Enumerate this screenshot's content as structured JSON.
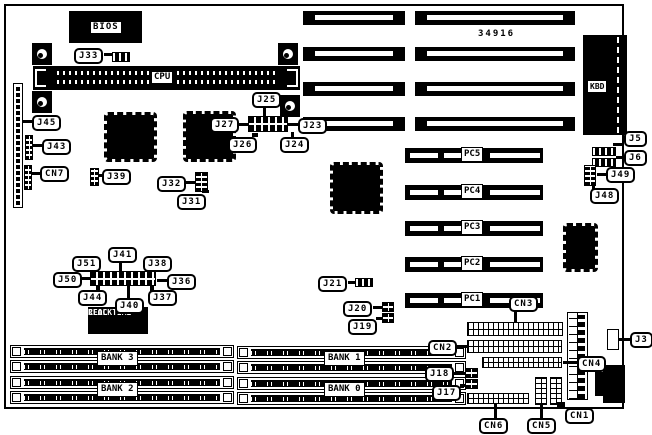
{
  "texts": {
    "bios": "BIOS",
    "cpu": "CPU",
    "kbd": "KBD",
    "board_number": "34916",
    "rtc_line1": "REAL TIME",
    "rtc_line2": "CLOCK"
  },
  "colors": {
    "foreground": "#000000",
    "background": "#ffffff"
  },
  "callouts": [
    {
      "t": "J33",
      "x": 74,
      "y": 48,
      "line": [
        104,
        53,
        9,
        3
      ]
    },
    {
      "t": "J45",
      "x": 32,
      "y": 115,
      "line": [
        22,
        120,
        10,
        3
      ]
    },
    {
      "t": "J43",
      "x": 42,
      "y": 139,
      "line": [
        33,
        144,
        9,
        3
      ]
    },
    {
      "t": "CN7",
      "x": 40,
      "y": 166,
      "line": [
        32,
        172,
        8,
        3
      ]
    },
    {
      "t": "J39",
      "x": 102,
      "y": 169,
      "line": [
        98,
        174,
        5,
        3
      ]
    },
    {
      "t": "J32",
      "x": 157,
      "y": 176,
      "line": [
        183,
        181,
        12,
        3
      ]
    },
    {
      "t": "J31",
      "x": 177,
      "y": 194,
      "line": [
        202,
        190,
        7,
        3
      ]
    },
    {
      "t": "J27",
      "x": 210,
      "y": 117,
      "line": [
        238,
        123,
        10,
        3
      ]
    },
    {
      "t": "J25",
      "x": 252,
      "y": 92,
      "line": [
        263,
        105,
        3,
        12
      ]
    },
    {
      "t": "J26",
      "x": 228,
      "y": 137,
      "line": [
        252,
        133,
        6,
        4
      ]
    },
    {
      "t": "J24",
      "x": 280,
      "y": 137,
      "line": [
        291,
        132,
        3,
        5
      ]
    },
    {
      "t": "J23",
      "x": 298,
      "y": 118,
      "line": [
        288,
        123,
        10,
        3
      ]
    },
    {
      "t": "J21",
      "x": 318,
      "y": 276,
      "line": [
        348,
        281,
        8,
        3
      ]
    },
    {
      "t": "J20",
      "x": 343,
      "y": 301,
      "line": [
        373,
        306,
        9,
        3
      ]
    },
    {
      "t": "J19",
      "x": 348,
      "y": 319,
      "line": [
        376,
        317,
        7,
        3
      ]
    },
    {
      "t": "J51",
      "x": 72,
      "y": 256,
      "line": [
        92,
        268,
        4,
        4
      ]
    },
    {
      "t": "J41",
      "x": 108,
      "y": 247,
      "line": [
        119,
        260,
        3,
        11
      ]
    },
    {
      "t": "J38",
      "x": 143,
      "y": 256,
      "line": [
        148,
        268,
        4,
        4
      ]
    },
    {
      "t": "J50",
      "x": 53,
      "y": 272,
      "line": [
        80,
        277,
        10,
        3
      ]
    },
    {
      "t": "J36",
      "x": 167,
      "y": 274,
      "line": [
        157,
        279,
        10,
        3
      ]
    },
    {
      "t": "J44",
      "x": 78,
      "y": 290,
      "line": [
        96,
        286,
        4,
        5
      ]
    },
    {
      "t": "J40",
      "x": 115,
      "y": 298,
      "line": [
        127,
        284,
        3,
        14
      ]
    },
    {
      "t": "J37",
      "x": 148,
      "y": 290,
      "line": [
        150,
        286,
        4,
        5
      ]
    },
    {
      "t": "J5",
      "x": 624,
      "y": 131,
      "line": [
        613,
        143,
        11,
        3
      ]
    },
    {
      "t": "J6",
      "x": 624,
      "y": 150,
      "line": [
        616,
        156,
        8,
        3
      ]
    },
    {
      "t": "J49",
      "x": 606,
      "y": 167,
      "line": [
        597,
        173,
        9,
        3
      ]
    },
    {
      "t": "J48",
      "x": 590,
      "y": 188,
      "line": [
        592,
        183,
        3,
        6
      ]
    },
    {
      "t": "J3",
      "x": 630,
      "y": 332,
      "line": [
        619,
        338,
        11,
        3
      ]
    },
    {
      "t": "CN3",
      "x": 509,
      "y": 296,
      "line": [
        514,
        311,
        3,
        11
      ]
    },
    {
      "t": "CN2",
      "x": 428,
      "y": 340,
      "line": [
        457,
        345,
        10,
        3
      ]
    },
    {
      "t": "CN4",
      "x": 577,
      "y": 356,
      "line": [
        563,
        361,
        14,
        3
      ]
    },
    {
      "t": "CN6",
      "x": 479,
      "y": 418,
      "line": [
        494,
        404,
        3,
        14
      ]
    },
    {
      "t": "CN5",
      "x": 527,
      "y": 418,
      "line": [
        540,
        404,
        3,
        14
      ]
    },
    {
      "t": "CN1",
      "x": 565,
      "y": 408,
      "line": [
        557,
        402,
        8,
        6
      ]
    },
    {
      "t": "J18",
      "x": 425,
      "y": 366,
      "line": [
        452,
        372,
        13,
        3
      ]
    },
    {
      "t": "J17",
      "x": 432,
      "y": 385,
      "line": [
        460,
        384,
        6,
        3
      ]
    }
  ],
  "isa_slots": {
    "h": 14,
    "items": [
      {
        "x": 303,
        "y": 11,
        "w": 102
      },
      {
        "x": 415,
        "y": 11,
        "w": 160
      },
      {
        "x": 303,
        "y": 47,
        "w": 102
      },
      {
        "x": 415,
        "y": 47,
        "w": 160
      },
      {
        "x": 303,
        "y": 82,
        "w": 102
      },
      {
        "x": 415,
        "y": 82,
        "w": 160
      },
      {
        "x": 303,
        "y": 117,
        "w": 102
      },
      {
        "x": 415,
        "y": 117,
        "w": 160
      }
    ]
  },
  "pc_slots": {
    "x": 405,
    "w": 138,
    "h": 15,
    "items": [
      {
        "label": "PC5",
        "y": 148
      },
      {
        "label": "PC4",
        "y": 185
      },
      {
        "label": "PC3",
        "y": 221
      },
      {
        "label": "PC2",
        "y": 257
      },
      {
        "label": "PC1",
        "y": 293
      }
    ]
  },
  "chips": [
    {
      "x": 104,
      "y": 112,
      "w": 53,
      "h": 50
    },
    {
      "x": 183,
      "y": 111,
      "w": 53,
      "h": 51
    },
    {
      "x": 330,
      "y": 162,
      "w": 53,
      "h": 52
    },
    {
      "x": 563,
      "y": 223,
      "w": 35,
      "h": 49
    }
  ],
  "connectors": [
    {
      "type": "hstrip",
      "x": 112,
      "y": 52,
      "w": 18,
      "h": 10
    },
    {
      "type": "vstrip",
      "x": 13,
      "y": 83,
      "w": 10,
      "h": 125
    },
    {
      "type": "vblock",
      "x": 25,
      "y": 135,
      "w": 8,
      "h": 25
    },
    {
      "type": "vblock",
      "x": 24,
      "y": 165,
      "w": 8,
      "h": 25
    },
    {
      "type": "vblock",
      "x": 90,
      "y": 168,
      "w": 9,
      "h": 18
    },
    {
      "type": "vblock",
      "x": 195,
      "y": 172,
      "w": 13,
      "h": 20
    },
    {
      "type": "jrow",
      "x": 248,
      "y": 116,
      "w": 40,
      "h": 16
    },
    {
      "type": "jrow",
      "x": 90,
      "y": 271,
      "w": 66,
      "h": 15
    },
    {
      "type": "hstrip",
      "x": 355,
      "y": 278,
      "w": 18,
      "h": 9
    },
    {
      "type": "vblock",
      "x": 382,
      "y": 302,
      "w": 12,
      "h": 10
    },
    {
      "type": "vblock",
      "x": 382,
      "y": 313,
      "w": 12,
      "h": 10
    },
    {
      "type": "hstrip",
      "x": 592,
      "y": 147,
      "w": 24,
      "h": 9
    },
    {
      "type": "hstrip",
      "x": 592,
      "y": 158,
      "w": 24,
      "h": 9
    },
    {
      "type": "vblock",
      "x": 584,
      "y": 165,
      "w": 12,
      "h": 21
    },
    {
      "type": "header",
      "x": 467,
      "y": 322,
      "w": 96,
      "h": 14
    },
    {
      "type": "header",
      "x": 467,
      "y": 340,
      "w": 95,
      "h": 13
    },
    {
      "type": "header",
      "x": 482,
      "y": 357,
      "w": 80,
      "h": 11
    },
    {
      "type": "header",
      "x": 467,
      "y": 393,
      "w": 62,
      "h": 11
    },
    {
      "type": "vheader",
      "x": 535,
      "y": 377,
      "w": 12,
      "h": 28
    },
    {
      "type": "vheader",
      "x": 550,
      "y": 377,
      "w": 12,
      "h": 28
    },
    {
      "type": "vblock",
      "x": 465,
      "y": 368,
      "w": 13,
      "h": 10
    },
    {
      "type": "vblock",
      "x": 465,
      "y": 379,
      "w": 13,
      "h": 10
    },
    {
      "type": "outl",
      "x": 607,
      "y": 329,
      "w": 12,
      "h": 21
    }
  ],
  "banks": {
    "row_h": 13,
    "groups": [
      {
        "x": 10,
        "w": 224,
        "label_x": 97,
        "banks": [
          {
            "label": "BANK 3",
            "rows": [
              345,
              360
            ],
            "label_y": 351
          },
          {
            "label": "BANK 2",
            "rows": [
              376,
              391
            ],
            "label_y": 382
          }
        ]
      },
      {
        "x": 237,
        "w": 229,
        "label_x": 324,
        "banks": [
          {
            "label": "BANK 1",
            "rows": [
              346,
              361
            ],
            "label_y": 351
          },
          {
            "label": "BANK 0",
            "rows": [
              377,
              392
            ],
            "label_y": 382
          }
        ]
      }
    ]
  }
}
